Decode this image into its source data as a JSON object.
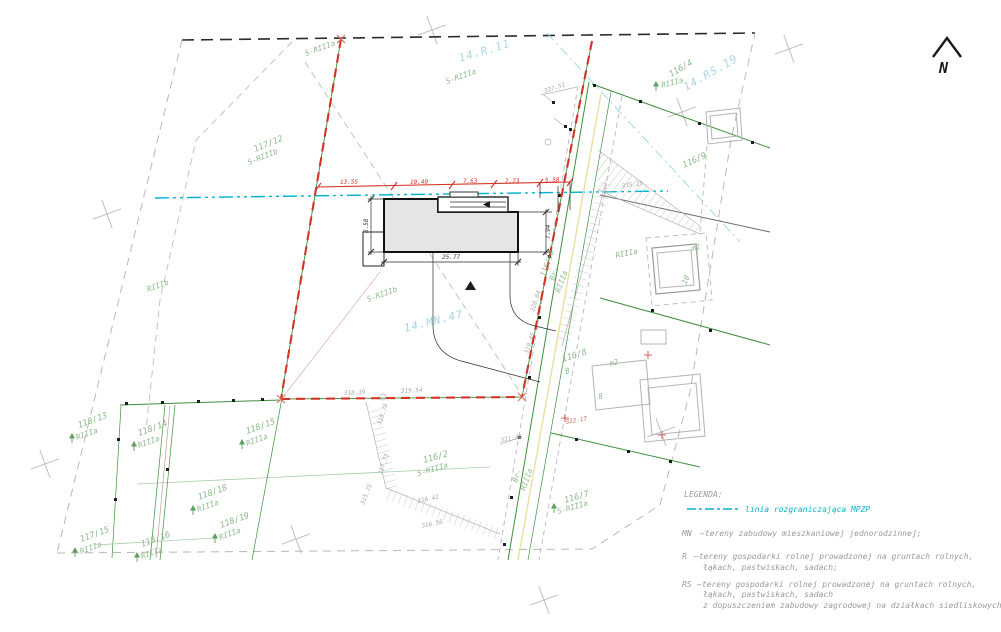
{
  "colors": {
    "boundary_red": "#d23323",
    "cadastral_green": "#3f8f3f",
    "label_green": "#8cba8c",
    "mpzp_cyan": "#00b4cc",
    "zone_cyan": "#a8d6e4",
    "gray_line": "#b8b8b8",
    "building_fill": "#e5e5e5",
    "road_yellow": "#e6dfa0",
    "text_gray": "#9a9a9a",
    "red_text": "#cc6b5e"
  },
  "north": {
    "label": "N"
  },
  "zones": {
    "r11": "14.R.11",
    "mn47": "14.MN.47",
    "rs19": "14.RS.19"
  },
  "labels": {
    "p117_12": "117/12",
    "s117_12": "S-RIIIb",
    "p116_4": "116/4",
    "s116_4": "RIIIa",
    "p116_9": "116/9",
    "r_road": "RIIIa",
    "p116_8": "116/8",
    "s116_8": "B",
    "p116_7": "116/7",
    "s116_7": "S-RIIIa",
    "p116_2": "116/2",
    "s116_2": "S-RIIIa",
    "p116_10": "116/10",
    "br2a": "Br-",
    "br2b": "RIIIa",
    "br1a": "Br-",
    "br1b": "RIIIa",
    "p118_13": "118/13",
    "s118_13": "RIIIa",
    "p118_14": "118/14",
    "s118_14": "RIIIa",
    "p118_15": "118/15",
    "s118_15": "RIIIa",
    "p118_18": "118/18",
    "s118_18": "RIIIa",
    "p118_19": "118/19",
    "s118_19": "RIIIa",
    "p118_16": "118/16",
    "s118_16": "RIIIa",
    "p117_15": "117/15",
    "s117_15": "RIIIa",
    "riiib": "RIIIb",
    "sriiia_t1": "S-RIIIa",
    "sriiia_t2": "S-RIIIa",
    "sriiib_m": "S-RIIIb",
    "bm2_a": "m2",
    "b10": "10",
    "bm2_b": "m2",
    "b8": "8"
  },
  "elev": {
    "e1": "327.51",
    "e2": "335.25",
    "e3": "322.17",
    "e4": "321.46",
    "e5": "318.39",
    "e6": "319.54",
    "e7": "318.79",
    "e8": "317.73",
    "e9": "315.75",
    "e10": "316.42",
    "e11": "316.56",
    "e12": "320.84",
    "e13": "319.45"
  },
  "dims": {
    "left": "8.58",
    "right": "7.94",
    "bottom": "25.77",
    "c1": "13.55",
    "c2": "10.40",
    "c3": "7.63",
    "c4": "7.73",
    "c5": "5.58"
  },
  "legend": {
    "title": "LEGENDA:",
    "line_item": "linia rozgraniczająca MPZP",
    "mn_code": "MN",
    "mn_text": "—tereny zabudowy mieszkaniowej jednorodzinnej;",
    "r_code": "R",
    "r_text1": "—tereny gospodarki rolnej prowadzonej na gruntach rolnych,",
    "r_text2": "łąkach, pastwiskach, sadach;",
    "rs_code": "RS",
    "rs_text1": "—tereny gospodarki rolnej prowadzonej na gruntach rolnych,",
    "rs_text2": "łąkach, pastwiskach, sadach",
    "rs_text3": "z dopuszczeniem zabudowy zagrodowej na działkach siedliskowych;"
  }
}
